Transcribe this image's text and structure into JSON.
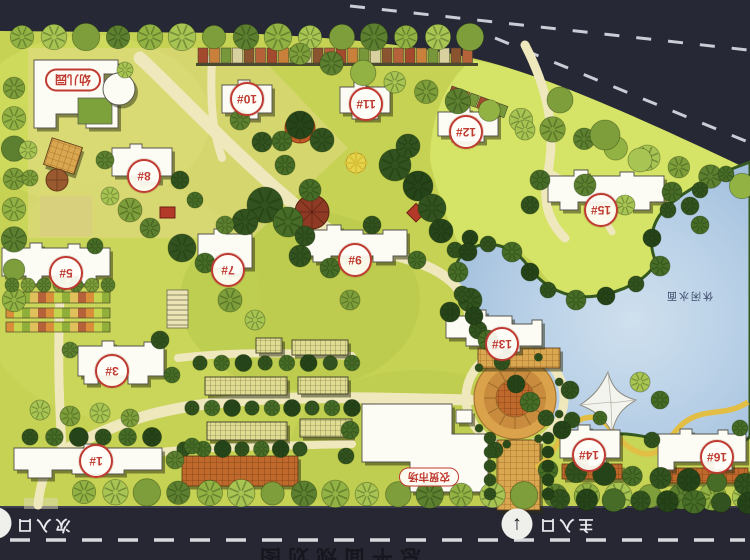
{
  "map": {
    "buildings": [
      {
        "label": "1#"
      },
      {
        "label": "3#"
      },
      {
        "label": "5#"
      },
      {
        "label": "7#"
      },
      {
        "label": "8#"
      },
      {
        "label": "9#"
      },
      {
        "label": "10#"
      },
      {
        "label": "11#"
      },
      {
        "label": "12#"
      },
      {
        "label": "13#"
      },
      {
        "label": "14#"
      },
      {
        "label": "15#"
      },
      {
        "label": "16#"
      }
    ],
    "facilities": {
      "kindergarten": "幼儿园",
      "market": "农贸市场"
    },
    "entrances": {
      "main": "主入口",
      "secondary": "次入口"
    },
    "icons": {
      "entrance_arrow": "↑"
    },
    "water_label": "休闲水面",
    "partial_caption": "总平面规划图"
  },
  "colors": {
    "label_red": "#bf3a30",
    "road_dark": "#272836",
    "water_blue": "#a7c4e0",
    "grass": "#c6d253"
  }
}
